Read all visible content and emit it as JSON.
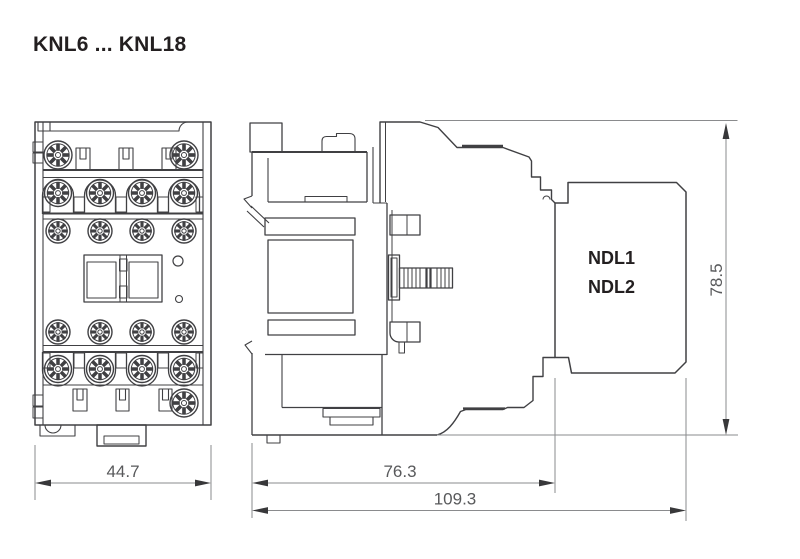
{
  "header": {
    "title": "KNL6 ... KNL18"
  },
  "drawing": {
    "front_view": {
      "name": "front view",
      "dimension_width": "44.7"
    },
    "side_view": {
      "name": "side view",
      "accessory_labels": [
        "NDL1",
        "NDL2"
      ],
      "dimension_depth_body": "76.3",
      "dimension_depth_total": "109.3",
      "dimension_height": "78.5"
    },
    "colors": {
      "line": "#404043",
      "dimension_line": "#8a8b8d",
      "dimension_text": "#58595b",
      "label_text": "#231f20",
      "background": "#ffffff"
    }
  }
}
